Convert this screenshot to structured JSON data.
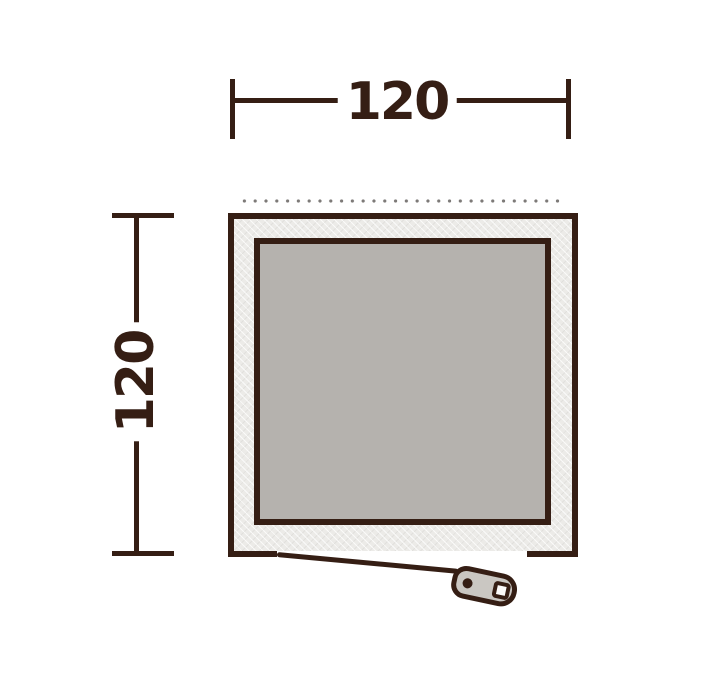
{
  "dimensions": {
    "width": {
      "label": "120"
    },
    "depth": {
      "label": "120"
    }
  },
  "floorplan": {
    "icons": {
      "zipper_pull": "zipper-pull-icon",
      "dotted_edge": "dotted-edge-line"
    },
    "colors": {
      "outline": "#351e14",
      "ring_fill": "#ecebe8",
      "inner_fill": "#b5b2ae",
      "pull_fill": "#cac7c2",
      "dot_gray": "#7d7a78",
      "background": "#ffffff"
    }
  }
}
